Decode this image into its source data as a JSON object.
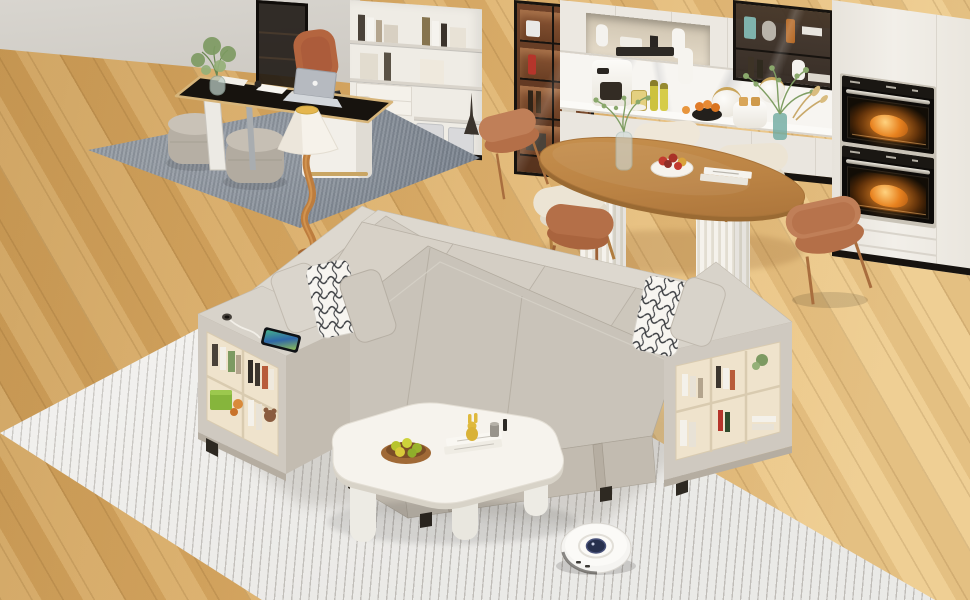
{
  "scene": {
    "type": "photorealistic 3d render, isometric view",
    "room": "open-plan living room with home office, kitchen and dining area",
    "focal_object": "L-shaped light-grey sectional sleeper sofa with pull-out bed and storage armrest bookshelves with USB charging port",
    "objects": [
      {
        "name": "sectional-sofa",
        "color_key": "sofa-top",
        "notes": "pull-out bed extended, fabric straps, storage shelves in both armrests"
      },
      {
        "name": "armrest-bookshelf-left",
        "notes": "two rows of books, green storage box, toys, USB port and smartphone on top"
      },
      {
        "name": "armrest-bookshelf-right",
        "notes": "three bays with books, plant and bottles"
      },
      {
        "name": "throw-pillows",
        "notes": "two white pillows with black scribble pattern, three plain greige pillows"
      },
      {
        "name": "striped-area-rug",
        "color_key": "rug-base"
      },
      {
        "name": "coffee-table",
        "notes": "white organic blob shape, woven bowl with green apples, white books, yellow bunny figurine"
      },
      {
        "name": "robot-vacuum",
        "color_key": "vacuum-body"
      },
      {
        "name": "floor-lamp",
        "notes": "white cone shade with gold top, twisted wood stem"
      },
      {
        "name": "office-desk",
        "notes": "black top with wood trim, white pedestal, silver laptop, plant, papers"
      },
      {
        "name": "office-chair",
        "color_key": "chair-clay"
      },
      {
        "name": "ottomans",
        "notes": "two round grey poufs on grey office rug"
      },
      {
        "name": "office-bookshelf",
        "notes": "cream shelving with books, storage bins, Eiffel tower figurine"
      },
      {
        "name": "glass-partition"
      },
      {
        "name": "walnut-display-cabinet",
        "notes": "lit shelves with bottles and glasses"
      },
      {
        "name": "kitchen-run",
        "notes": "marble backsplash, coffee machine, oil bottles, oranges, toaster, jar vases, teal vase with greenery"
      },
      {
        "name": "upper-glass-cabinet",
        "notes": "black frame, bottles, astronaut figurine"
      },
      {
        "name": "double-wall-ovens",
        "notes": "roast chicken glowing inside both ovens"
      },
      {
        "name": "dining-table",
        "notes": "oval wood top, two white fluted pedestals, eucalyptus vase, fruit bowl, books"
      },
      {
        "name": "dining-chairs",
        "notes": "three cream curved chairs, three terracotta curved chairs, wood legs"
      },
      {
        "name": "oak-floor",
        "color_key": "floor-main"
      }
    ]
  },
  "palette": {
    "wall": "#cbc7c0",
    "floor-main": "#e3b875",
    "floor-deep": "#c99a55",
    "rug-base": "#f2f1ee",
    "rug-stripe": "#c6c3be",
    "office-rug": "#949ba3",
    "sofa-top": "#d8d3ca",
    "sofa-face": "#cbc5bb",
    "sofa-dark": "#b5aea2",
    "shelf-inset": "#efe3cc",
    "cabinet-cream": "#efece5",
    "cabinet-walnut": "#6e4128",
    "frame-black": "#17130f",
    "counter": "#f7f5f1",
    "steel": "#c9c3b7",
    "glow": "#e8821f",
    "table-wood": "#bb8344",
    "leg-wood": "#b07c3f",
    "chair-clay": "#bf7e56",
    "chair-cream": "#ece4d4",
    "lamp-shade": "#f6f2ea",
    "lamp-gold": "#e5b64e",
    "lamp-stem": "#bd7d3e",
    "coffee-table": "#f6f3ed",
    "vacuum-body": "#f5f4f1",
    "vacuum-hub": "#27304d",
    "pillow-white": "#f7f5f0",
    "pillow-ink": "#23262b",
    "apple-green": "#b7c42e",
    "apple-red": "#c23a2f",
    "fruit-orange": "#e07b28"
  }
}
